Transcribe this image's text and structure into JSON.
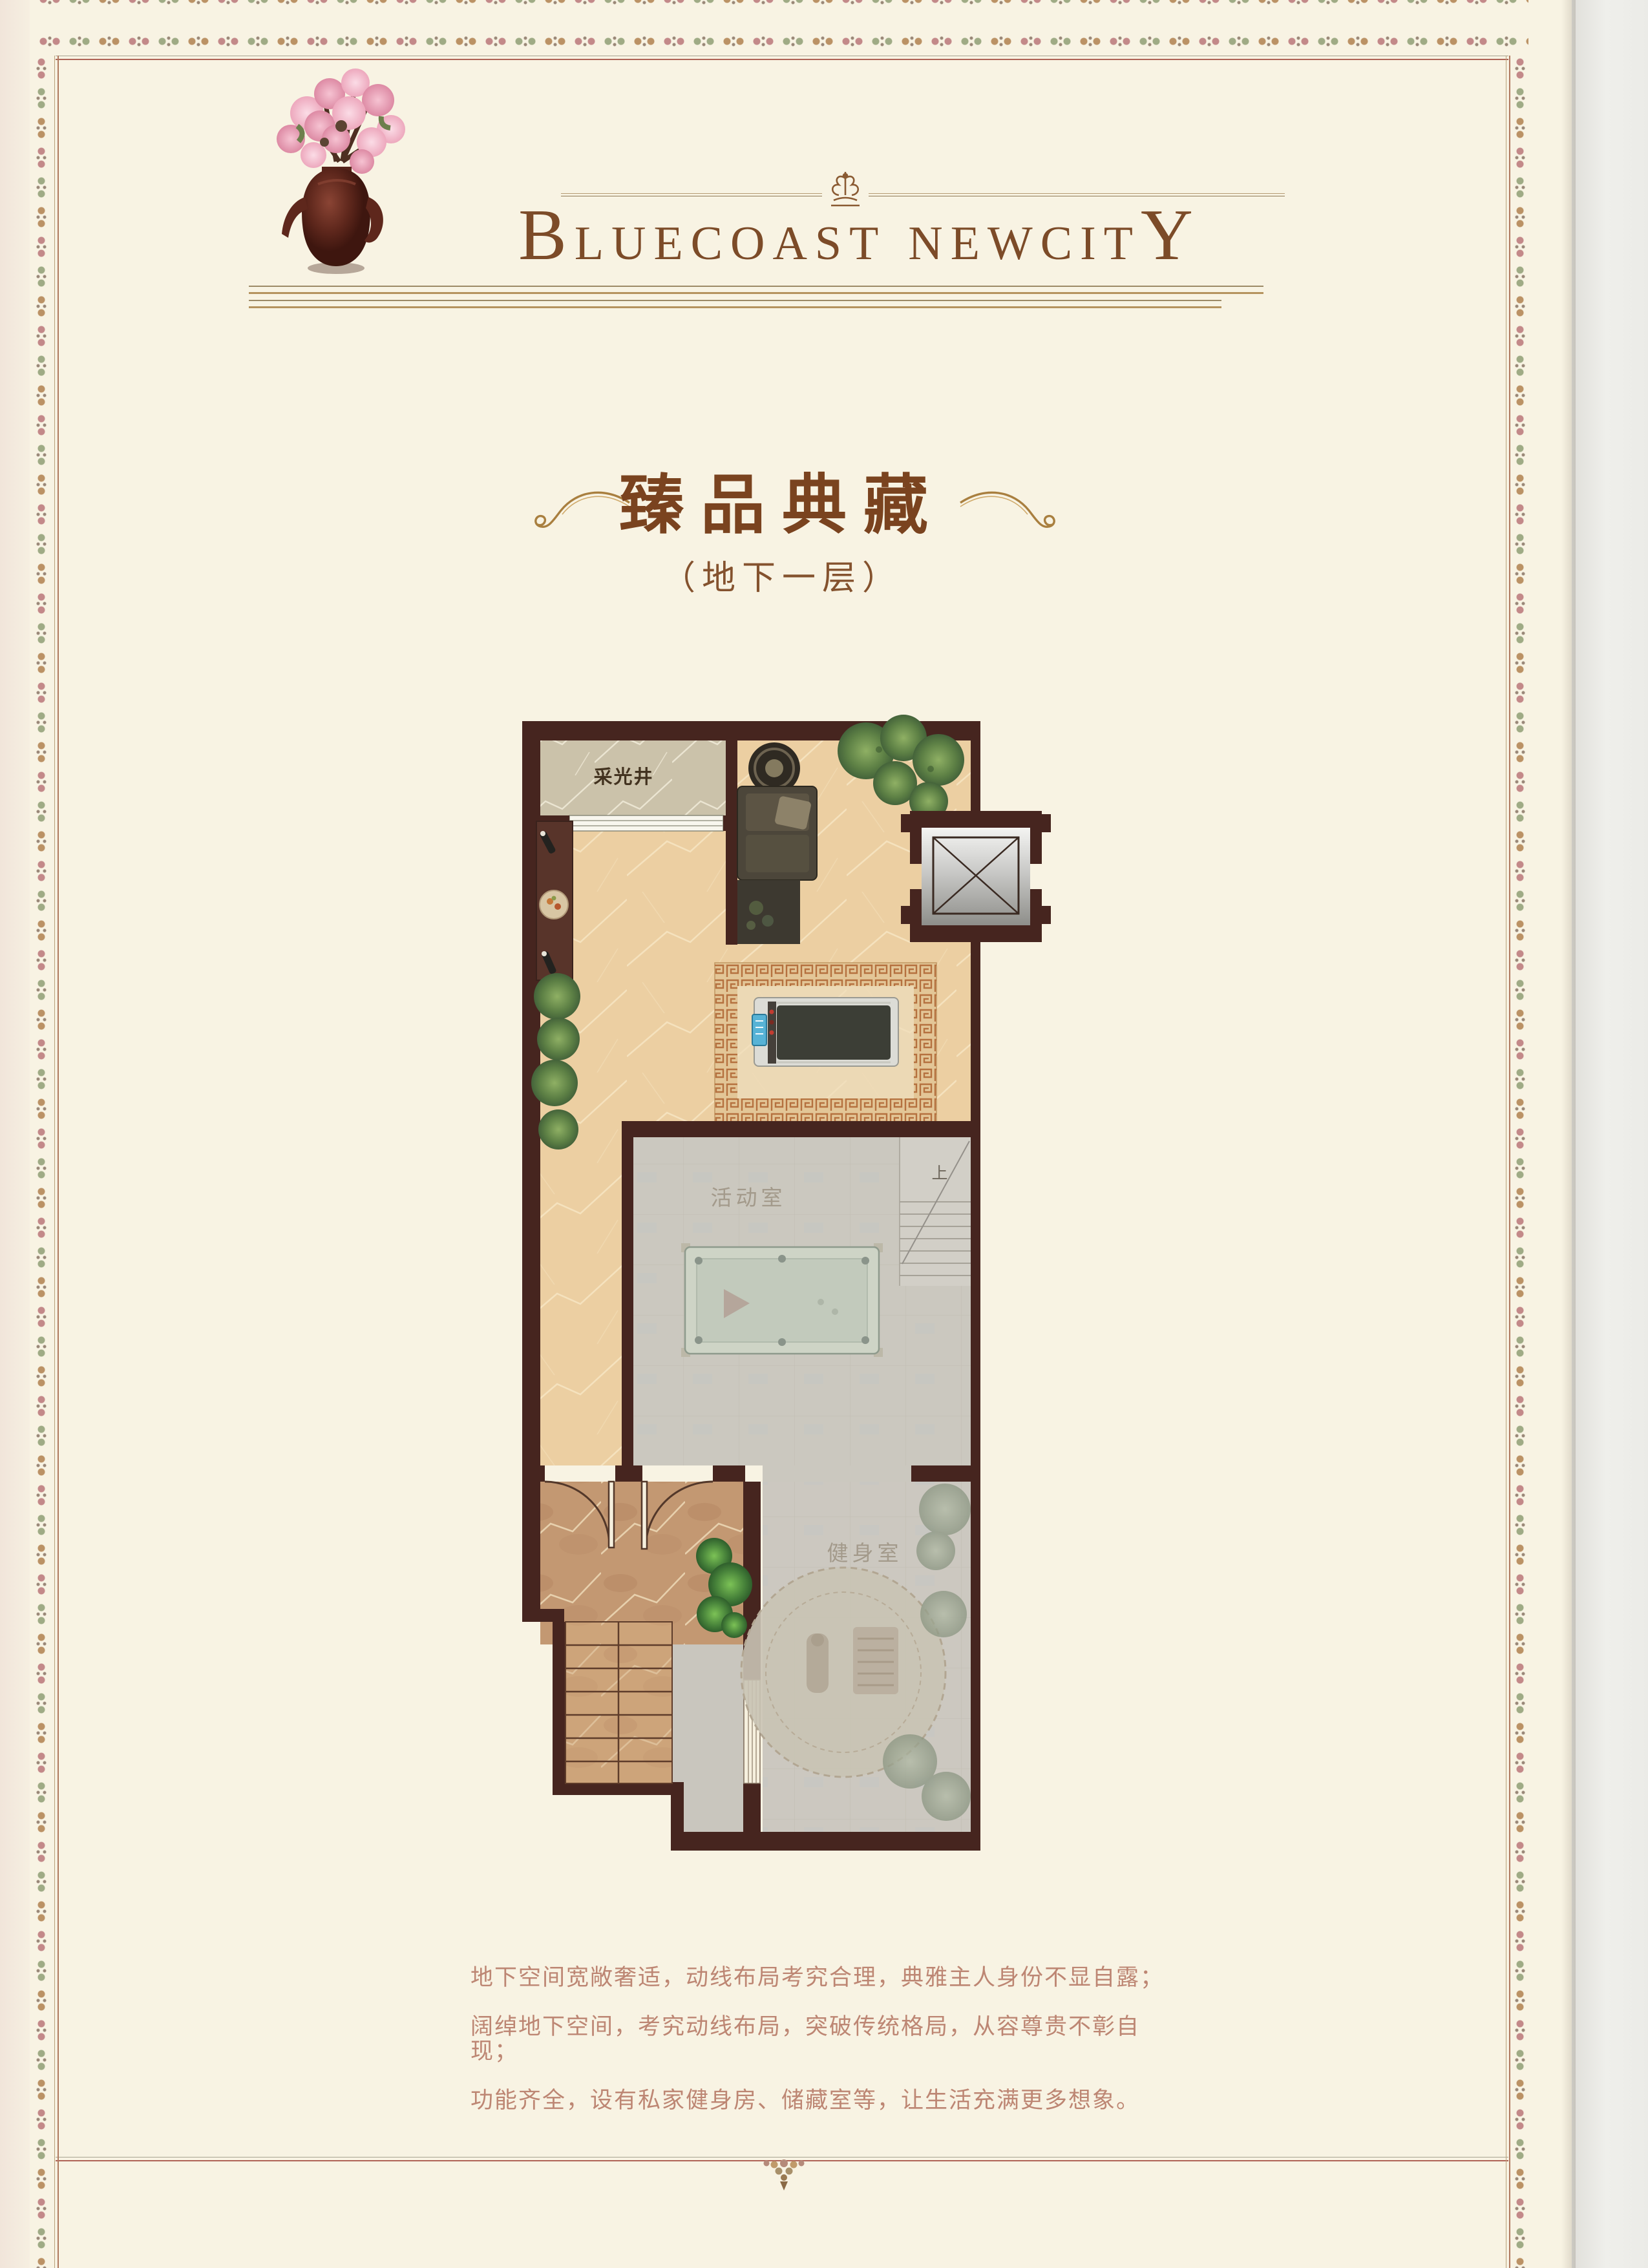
{
  "header": {
    "brand": {
      "initial": "B",
      "part1": "LUECOAST",
      "part2": "NEWCIT",
      "final": "Y"
    }
  },
  "section_title": {
    "main": "臻品典藏",
    "sub": "（地下一层）"
  },
  "floor_plan": {
    "rooms": [
      {
        "label": "采光井"
      },
      {
        "label": "活动室"
      },
      {
        "label": "健身室"
      }
    ],
    "stairs_label": "上"
  },
  "description": {
    "lines": [
      "地下空间宽敞奢适，动线布局考究合理，典雅主人身份不显自露；",
      "阔绰地下空间，考究动线布局，突破传统格局，从容尊贵不彰自现；",
      "功能齐全，设有私家健身房、储藏室等，让生活充满更多想象。"
    ]
  },
  "colors": {
    "brand_text": "#7c4b28",
    "title_text": "#7a431f",
    "body_text": "#bd8673",
    "wall": "#46251f",
    "floor_beige": "#eccfa2",
    "floor_grey": "#cbc8bf",
    "hall_marble": "#c39872",
    "accent_gold": "#b5935e"
  }
}
